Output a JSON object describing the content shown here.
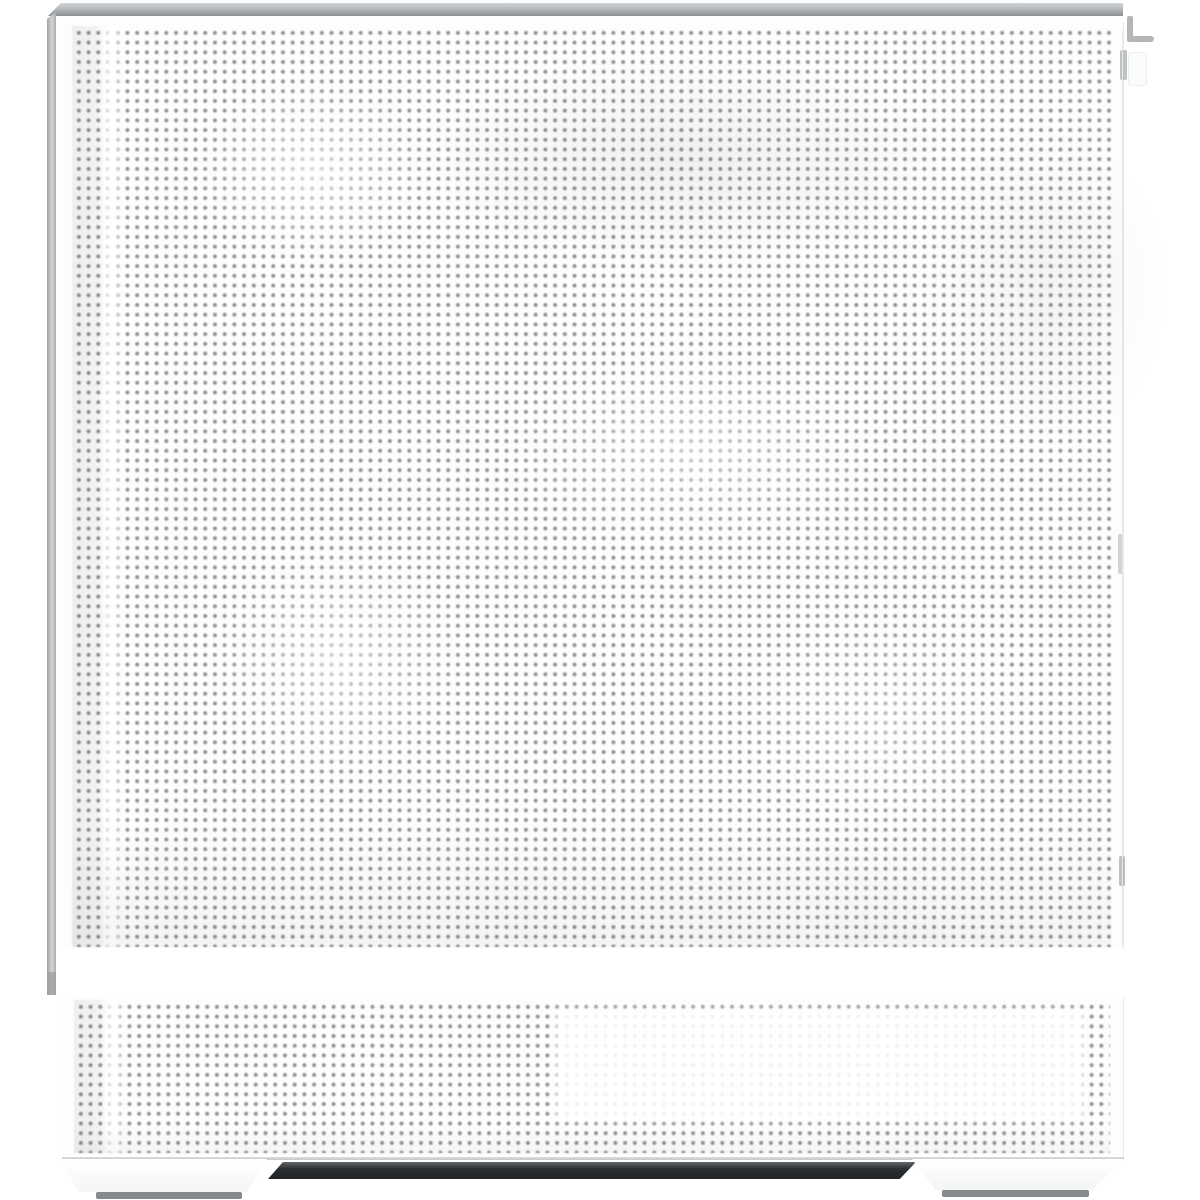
{
  "scene": {
    "type": "product-photo",
    "subject": "White desktop PC case, side view of perforated mesh side panel",
    "text_content": "none"
  },
  "colors": {
    "background": "#ffffff",
    "panel": "#fdfdfd",
    "mesh_dot": "#8f9193",
    "frame_silver": "#b6babc",
    "frame_silver_light": "#d2d5d7",
    "frame_silver_dark": "#8b8f92",
    "bottom_recess": "#2b2f32",
    "bottom_recess_light": "#63676a",
    "foot_pad": "#868a8d",
    "edge_line": "#e6e8e9"
  },
  "parts": {
    "top_rail": "silver top edge trim of the case",
    "left_rail": "silver front edge trim of the case",
    "main_mesh_panel": "large perforated mesh side panel",
    "bottom_mesh_panel": "lower perforated vent band (power supply area)",
    "psu_highlight": "light reflective rectangle on lower vent band",
    "latch_hook": "rear panel latch hook at top right",
    "latch_tab": "rear panel pull tab below the hook",
    "bottom_recess": "dark recessed underside strip between the feet",
    "left_foot": "front case foot with gray rubber pad",
    "right_foot": "rear case foot with gray rubber pad"
  }
}
